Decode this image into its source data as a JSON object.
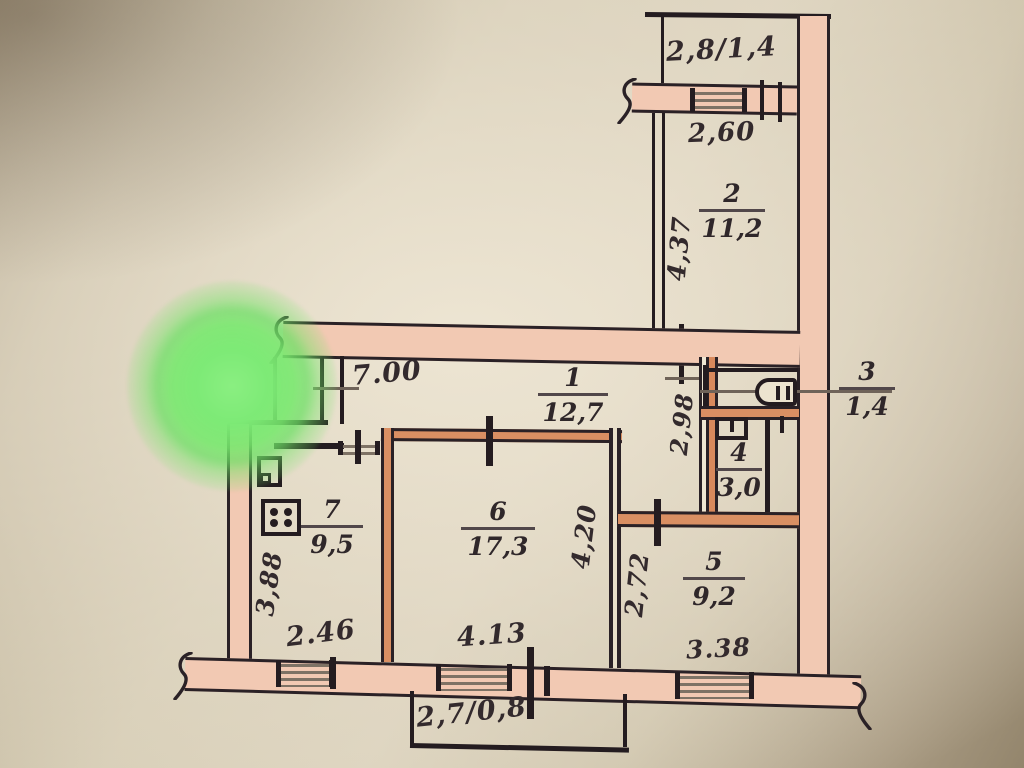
{
  "palette": {
    "paper": "#d8cfb8",
    "wall_fill_pink": "#f2c9b3",
    "wall_fill_orange": "#d98f63",
    "ink": "#241c20",
    "highlight_green": "#7dea76"
  },
  "rooms": [
    {
      "number": "1",
      "area": "12,7"
    },
    {
      "number": "2",
      "area": "11,2"
    },
    {
      "number": "3",
      "area": "1,4"
    },
    {
      "number": "4",
      "area": "3,0"
    },
    {
      "number": "5",
      "area": "9,2"
    },
    {
      "number": "6",
      "area": "17,3"
    },
    {
      "number": "7",
      "area": "9,5"
    }
  ],
  "dims": {
    "top_balcony": "2,8/1,4",
    "top_window": "2,60",
    "room2_depth": "4,37",
    "hall_width": "7.00",
    "wc_depth": "2,98",
    "kitchen_depth": "3,88",
    "kitchen_width": "2.46",
    "room6_depth": "4,20",
    "room6_width": "4.13",
    "room5_depth": "2,72",
    "room5_width": "3.38",
    "bottom_balcony": "2,7/0,8"
  }
}
